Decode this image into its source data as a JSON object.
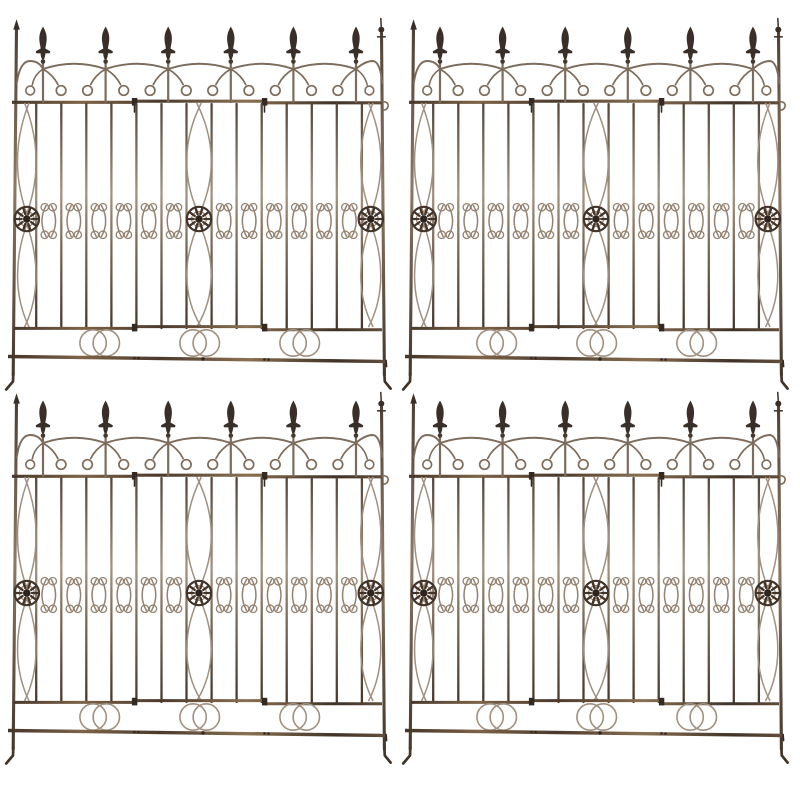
{
  "scene": {
    "kind": "product-photo",
    "subject": "antique rusted wrought-iron garden fence panels",
    "background": "#ffffff",
    "arrangement": {
      "rows": 2,
      "cols": 2,
      "panel_count": 4
    },
    "panels": [
      {
        "name": "fence-panel-1",
        "x": 3,
        "y": 1
      },
      {
        "name": "fence-panel-2",
        "x": 400,
        "y": 1
      },
      {
        "name": "fence-panel-3",
        "x": 3,
        "y": 375
      },
      {
        "name": "fence-panel-4",
        "x": 400,
        "y": 375
      }
    ]
  },
  "colors": {
    "bg": "#ffffff",
    "spear": "#3a2f28",
    "collar": "#463a30",
    "wire_light": "#a09080",
    "wire_mid": "#948372",
    "wire_dark": "#7d6c5b",
    "rosette": "#43342a",
    "rosette_center": "#2f241c",
    "rosette_hl": "#937d6a",
    "clip": "#342a22",
    "bar_stops": [
      "#54463a",
      "#a4937f",
      "#7e6c5a",
      "#46382d"
    ],
    "rail_stops": [
      "#3f3227",
      "#7e6347",
      "#4a3a2c",
      "#8a7052",
      "#3f3227",
      "#6b5440"
    ],
    "post_stops": [
      "#4a3c31",
      "#8d7a66",
      "#3e3126"
    ]
  },
  "panel_design": {
    "width": 392,
    "height": 392,
    "top_rail_y": 101,
    "mid_rail_y": 327,
    "ground_rail": {
      "x1": 5,
      "y1": 355.5,
      "x2": 383,
      "y2": 360.5
    },
    "posts": {
      "left": {
        "x_top": 13.5,
        "x_bottom": 10.2,
        "y_top": 26,
        "y_bottom": 374,
        "finial": "cone"
      },
      "right": {
        "x_top": 378.5,
        "x_bottom": 381.4,
        "y_top": 32,
        "y_bottom": 374,
        "finial": "ball"
      }
    },
    "finials": {
      "count": 6,
      "xs": [
        40,
        102.6,
        165.2,
        227.8,
        290.4,
        353
      ],
      "tip_y": 25.5,
      "collar_y": 60.5
    },
    "scallops": {
      "cusp_y": 68,
      "peak_ctrl_y": 57.5,
      "curl_y": 89.5,
      "curl_r": 4.8,
      "curl_dx": 13.2
    },
    "bars": {
      "count": 14,
      "top_y": 103,
      "bottom_y": 327,
      "xs": [
        33.2,
        58.3,
        83.3,
        108.4,
        133.4,
        158.5,
        183.5,
        208.6,
        233.6,
        258.7,
        283.7,
        308.8,
        333.8,
        358.9
      ]
    },
    "lens_columns": [
      {
        "cx": 23.8,
        "spread": 13
      },
      {
        "cx": 196,
        "spread": 17
      },
      {
        "cx": 367.8,
        "spread": 14
      }
    ],
    "rosettes": {
      "count": 3,
      "xs": [
        23.8,
        196,
        367.8
      ],
      "y": 218,
      "r": 12.2
    },
    "scroll_motifs": {
      "top_y": 204.5,
      "bottom_y": 235.5,
      "curl_r": 3.7,
      "curl_y_top": 206.2,
      "curl_y_bottom": 233.8
    },
    "rings": {
      "pairs": 3,
      "cxs": [
        96.7,
        196.7,
        296.7
      ],
      "cy": 342,
      "r": 13.2,
      "dx": 6.6
    },
    "clips_x": [
      131.5,
      261.5
    ],
    "feet_y": 389
  }
}
